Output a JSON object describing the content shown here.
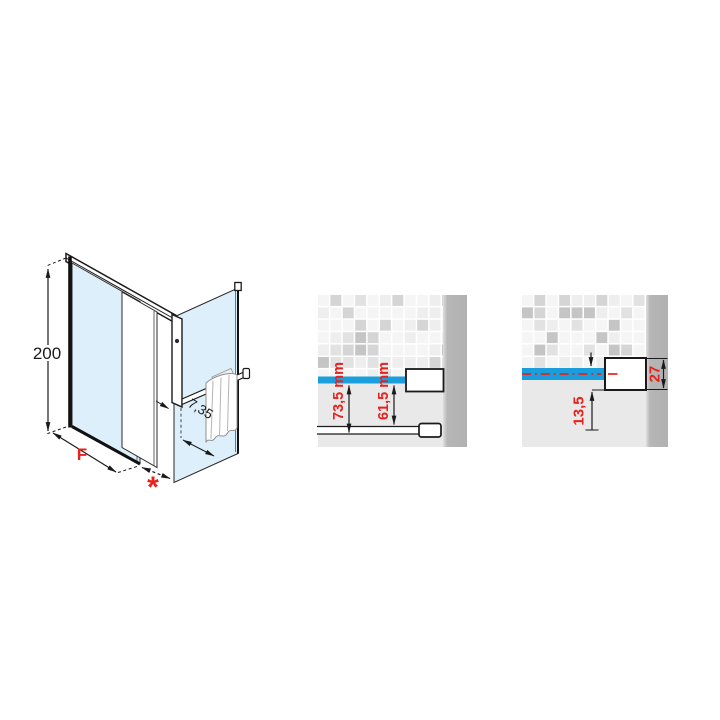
{
  "page": {
    "background": "#ffffff"
  },
  "colors": {
    "glass_blue": "#ddeffa",
    "line_black": "#1a1a1a",
    "dimension_red": "#e8211d",
    "water_level_blue": "#1b9fdc",
    "wall_band_gray": "#b2b2b2",
    "floor_gray": "#e9e9e9"
  },
  "diagrams": {
    "isometric": {
      "description": "shower enclosure isometric view with sliding door, side panel and towel rail",
      "labels": {
        "height": "200",
        "width": "F",
        "gap": "*",
        "offset": "7,35"
      }
    },
    "detail_mid": {
      "description": "wall section detail with water level line and profiles",
      "labels": {
        "outer": "73,5 mm",
        "inner": "61,5 mm"
      }
    },
    "detail_right": {
      "description": "wall section detail with profile cross-section",
      "labels": {
        "bottom": "13,5",
        "profile": "27"
      }
    }
  },
  "mosaic": {
    "palette": [
      "#f5f5f5",
      "#eeeeee",
      "#e2e2e2",
      "#d5d5d5",
      "#c5c5c5"
    ],
    "thresholds": [
      0.4,
      0.62,
      0.8,
      0.92
    ]
  }
}
